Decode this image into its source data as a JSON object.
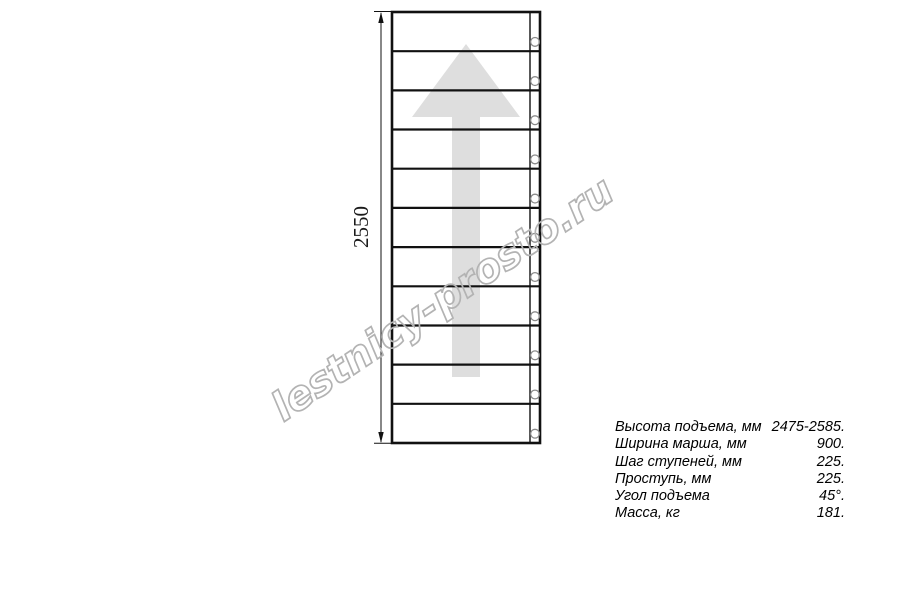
{
  "drawing": {
    "type": "straight-staircase-plan",
    "dimension_label": "2550",
    "treads": 11,
    "mount_holes": 11,
    "direction_arrow": "up",
    "arrow_color": "#dedede",
    "line_color": "#111111"
  },
  "watermark": {
    "text": "lestnicy-prosto.ru",
    "stroke_color": "#b3b3b3"
  },
  "specs": {
    "rows": [
      {
        "label": "Высота подъема, мм",
        "value": "2475-2585."
      },
      {
        "label": "Ширина марша, мм",
        "value": "900."
      },
      {
        "label": "Шаг ступеней, мм",
        "value": "225."
      },
      {
        "label": "Проступь, мм",
        "value": "225."
      },
      {
        "label": "Угол подъема",
        "value": "45°."
      },
      {
        "label": "Масса, кг",
        "value": "181."
      }
    ]
  }
}
